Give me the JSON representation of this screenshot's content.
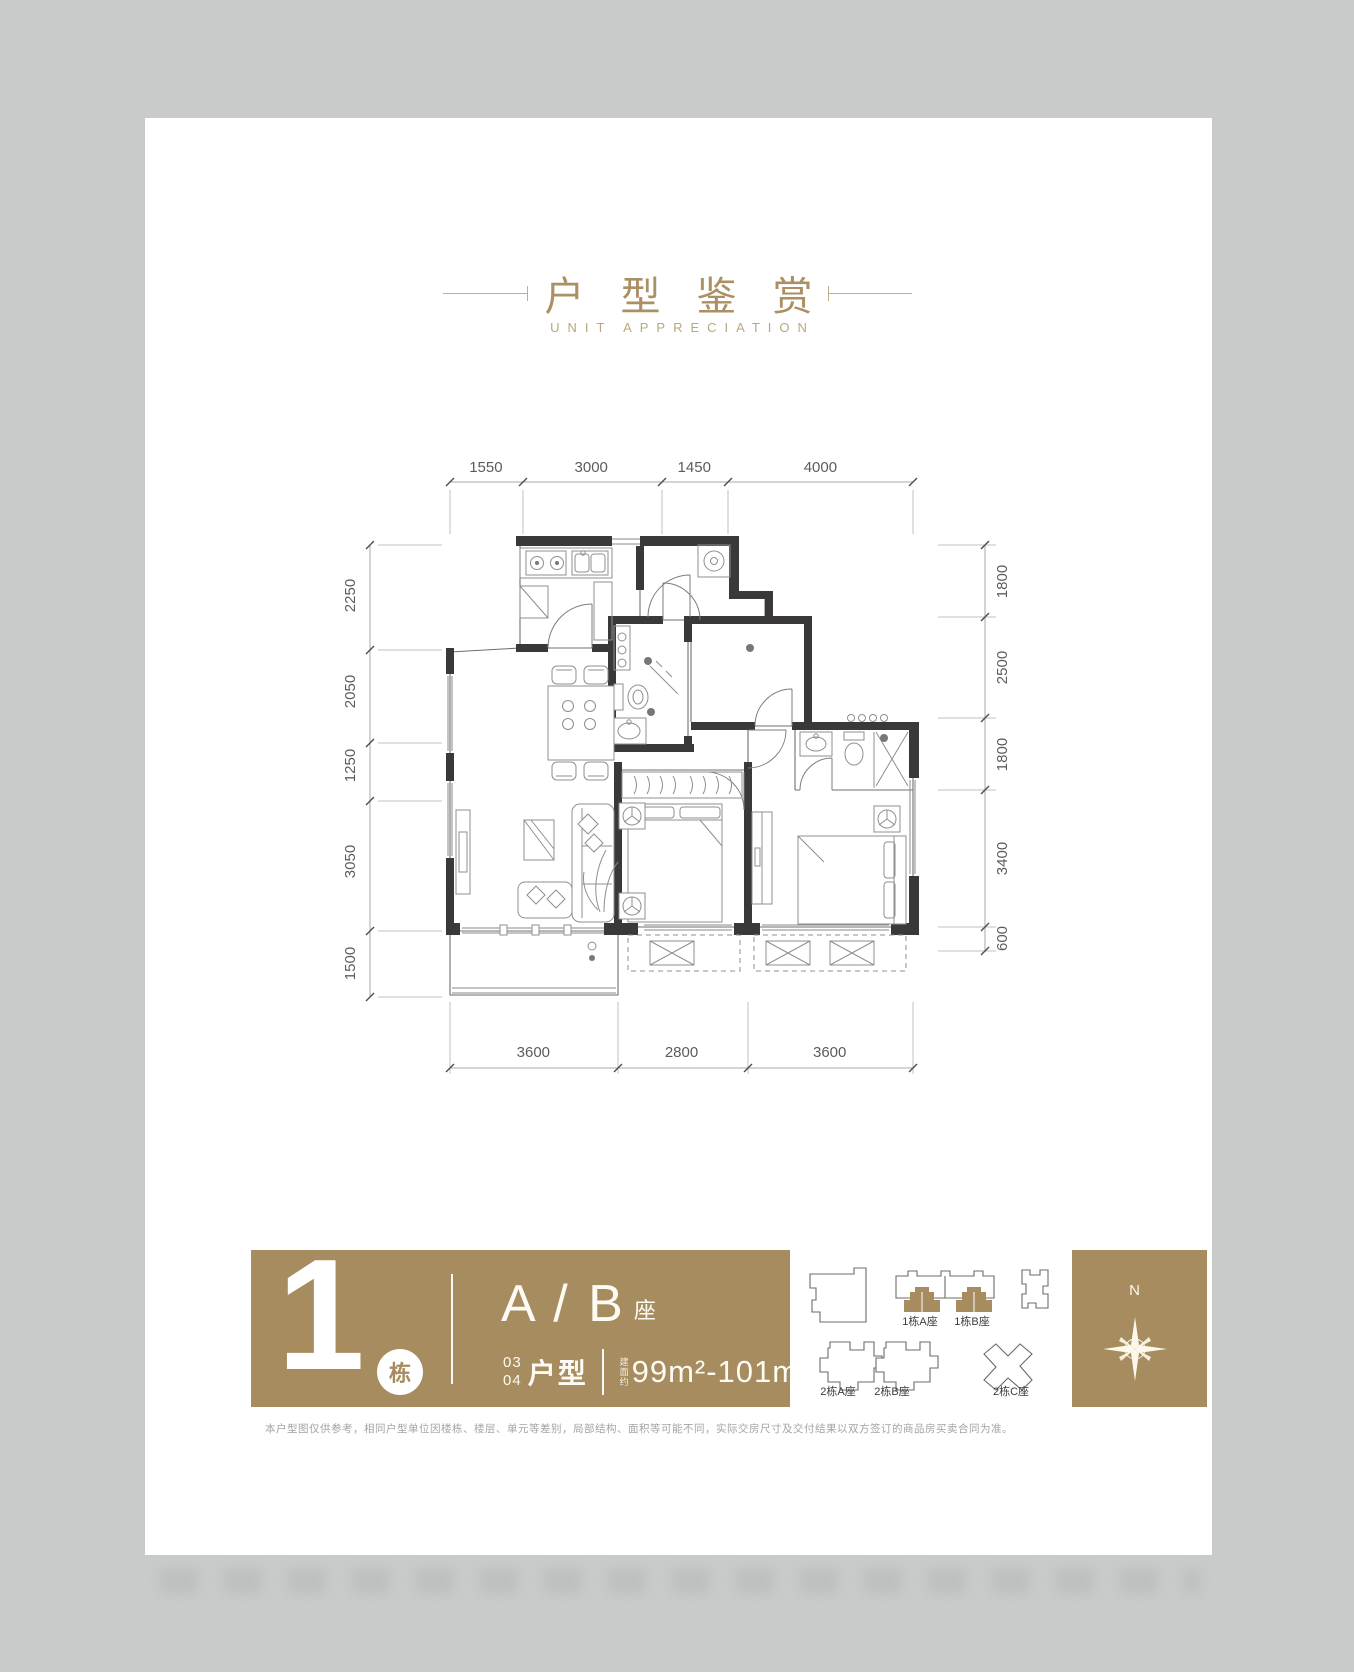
{
  "header": {
    "title": "户型鉴赏",
    "subtitle": "UNIT APPRECIATION",
    "accent_color": "#ab9064"
  },
  "floor_plan": {
    "dimensions_mm": {
      "top": [
        "1550",
        "3000",
        "1450",
        "4000"
      ],
      "bottom": [
        "3600",
        "2800",
        "3600"
      ],
      "left": [
        "2250",
        "2050",
        "1250",
        "3050",
        "1500"
      ],
      "right": [
        "1800",
        "2500",
        "1800",
        "3400",
        "600"
      ]
    }
  },
  "info_band": {
    "background": "#a68c5e",
    "building_number": "1",
    "building_suffix": "栋",
    "block_label": "A / B",
    "block_suffix": "座",
    "unit_no_top": "03",
    "unit_no_bottom": "04",
    "unit_type_label": "户型",
    "area_prefix": "建面约",
    "area_range": "99m²-101m²"
  },
  "site_plan": {
    "labels": [
      "1栋A座",
      "1栋B座",
      "2栋A座",
      "2栋B座",
      "2栋C座"
    ]
  },
  "compass": {
    "north_label": "N"
  },
  "disclaimer": "本户型图仅供参考，相同户型单位因楼栋、楼层、单元等差别，局部结构、面积等可能不同，实际交房尺寸及交付结果以双方签订的商品房买卖合同为准。"
}
